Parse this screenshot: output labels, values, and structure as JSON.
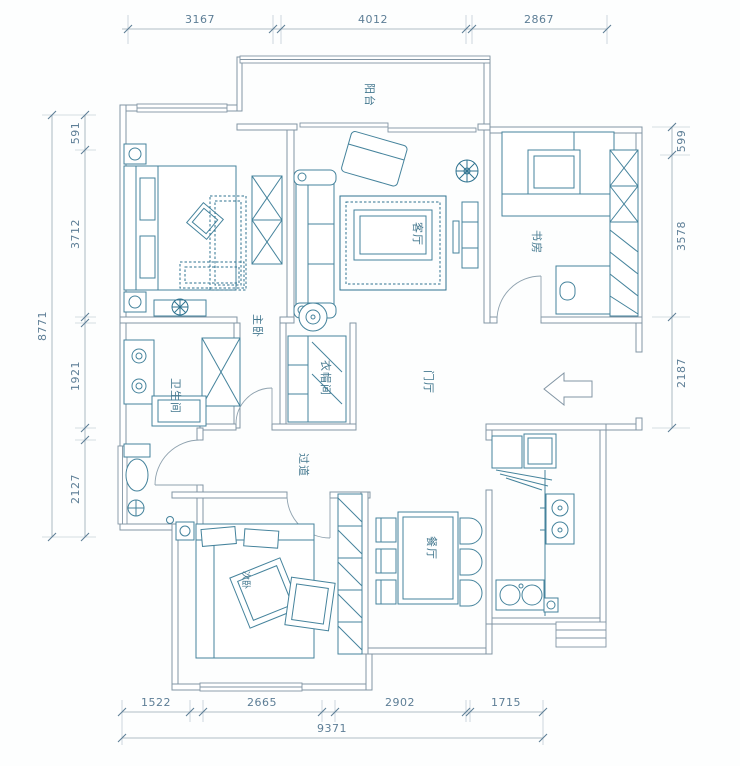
{
  "plan": {
    "type": "apartment-floor-plan",
    "language": "zh-CN"
  },
  "rooms": {
    "balcony": "阳台",
    "living": "客厅",
    "study": "书房",
    "master": "主卧",
    "cloakroom": "衣帽间",
    "bathroom": "卫生间",
    "hall": "门厅",
    "corridor": "过道",
    "bedroom2": "次卧",
    "dining": "餐厅"
  },
  "dimensions": {
    "top": [
      "3167",
      "4012",
      "2867"
    ],
    "bottom": [
      "1522",
      "2665",
      "2902",
      "1715"
    ],
    "bottom_total": "9371",
    "left": [
      "591",
      "3712",
      "1921",
      "2127"
    ],
    "left_total": "8771",
    "right": [
      "599",
      "3578",
      "2187"
    ]
  },
  "icons": {
    "entry_arrow": "block-arrow-left"
  },
  "colors": {
    "wall": "#8295a4",
    "furniture": "#45839c",
    "dimension_text": "#5d7e96",
    "label_text": "#44788f",
    "background": "#fdfefe"
  }
}
